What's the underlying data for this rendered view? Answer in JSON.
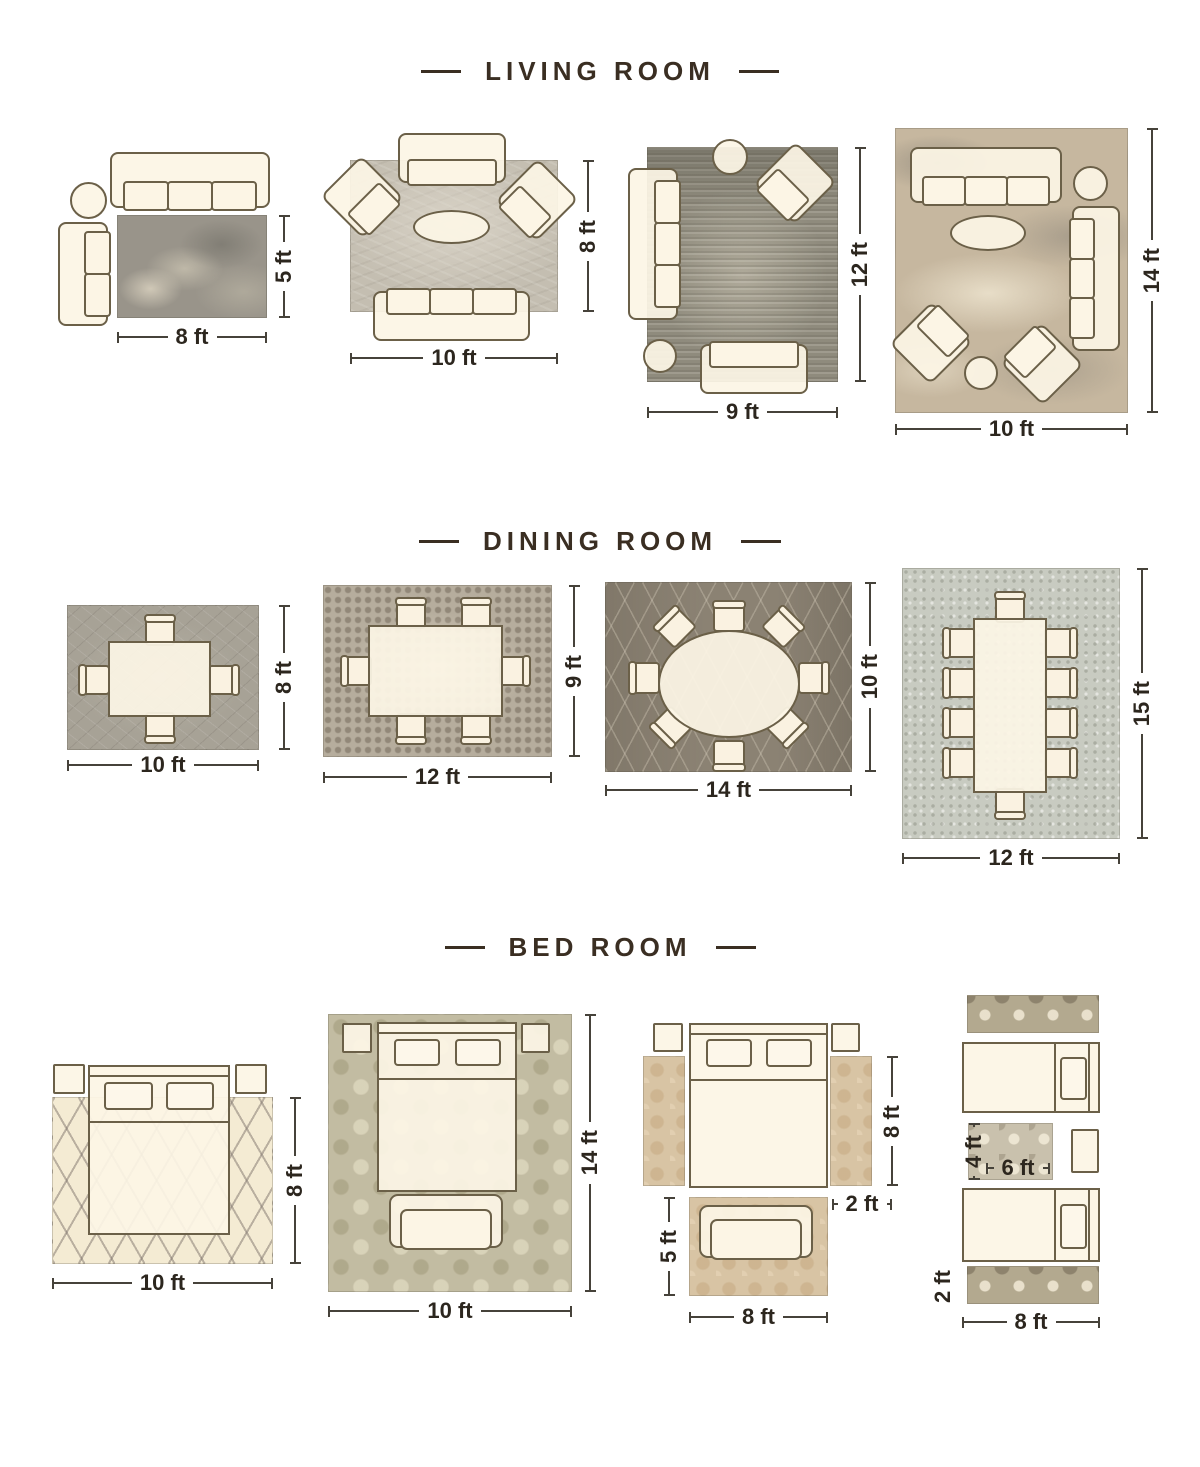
{
  "sections": [
    {
      "title": "LIVING ROOM",
      "layouts": [
        {
          "width": "8 ft",
          "height": "5 ft"
        },
        {
          "width": "10 ft",
          "height": "8 ft"
        },
        {
          "width": "9 ft",
          "height": "12 ft"
        },
        {
          "width": "10 ft",
          "height": "14 ft"
        }
      ]
    },
    {
      "title": "DINING ROOM",
      "layouts": [
        {
          "width": "10 ft",
          "height": "8 ft"
        },
        {
          "width": "12 ft",
          "height": "9 ft"
        },
        {
          "width": "14 ft",
          "height": "10 ft"
        },
        {
          "width": "12 ft",
          "height": "15 ft"
        }
      ]
    },
    {
      "title": "BED ROOM",
      "layouts": [
        {
          "width": "10 ft",
          "height": "8 ft"
        },
        {
          "width": "10 ft",
          "height": "14 ft"
        },
        {
          "side_runner_length": "8 ft",
          "side_runner_width": "2 ft",
          "foot_rug_height": "5 ft",
          "foot_rug_width": "8 ft"
        },
        {
          "between_rug_height": "4 ft",
          "between_rug_width": "6 ft",
          "runner_width": "2 ft",
          "runner_length": "8 ft"
        }
      ]
    }
  ],
  "colors": {
    "heading": "#3a2e22",
    "dimension_text": "#2c261e",
    "furniture_fill": "#fbf4e4",
    "furniture_outline": "#6b6048"
  }
}
